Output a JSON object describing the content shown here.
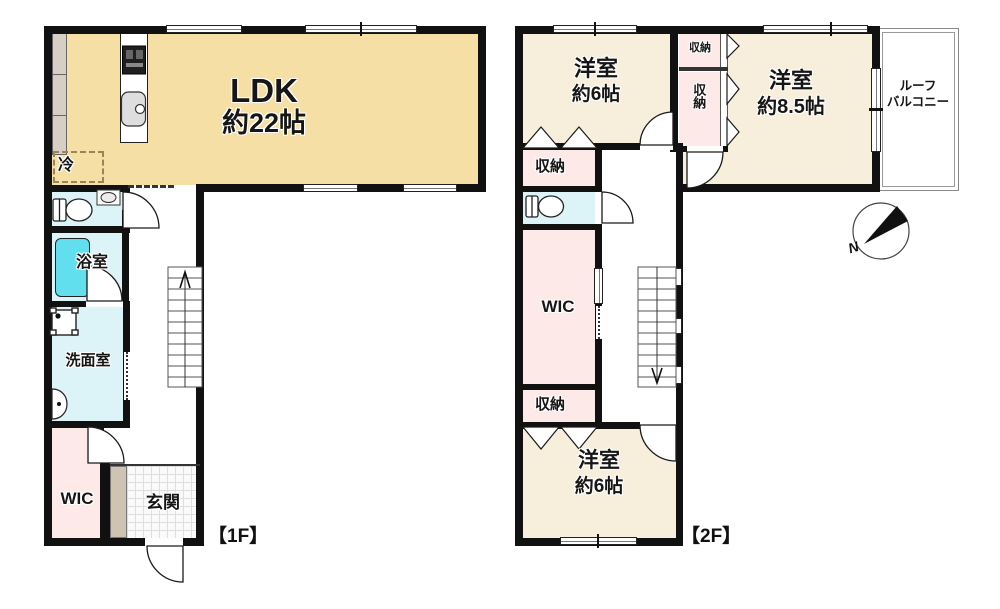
{
  "title": "2-story house floor plan",
  "colors": {
    "wall": "#111111",
    "ldk_fill": "#f5dfa5",
    "bedroom_fill": "#f7eedb",
    "closet_pink": "#fce9e8",
    "wet_room_cyan": "#dcf3f7",
    "bathtub_cyan": "#62dfee",
    "entrance_strip_tan": "#cfc3b1",
    "kitchen_counter_tan": "#d7cfc3"
  },
  "floor1": {
    "floor_label": "【1F】",
    "ldk_name": "LDK",
    "ldk_size": "約22帖",
    "fridge": "冷",
    "bathroom": "浴室",
    "washroom": "洗面室",
    "wic": "WIC",
    "entrance": "玄関"
  },
  "floor2": {
    "floor_label": "【2F】",
    "bedroom_nw_name": "洋室",
    "bedroom_nw_size": "約6帖",
    "bedroom_ne_name": "洋室",
    "bedroom_ne_size": "約8.5帖",
    "bedroom_s_name": "洋室",
    "bedroom_s_size": "約6帖",
    "closet_top": "収納",
    "closet_mid": "収納",
    "closet_left_upper": "収納",
    "closet_left_lower": "収納",
    "wic": "WIC",
    "balcony_line1": "ルーフ",
    "balcony_line2": "バルコニー"
  },
  "compass": {
    "north": "N"
  }
}
